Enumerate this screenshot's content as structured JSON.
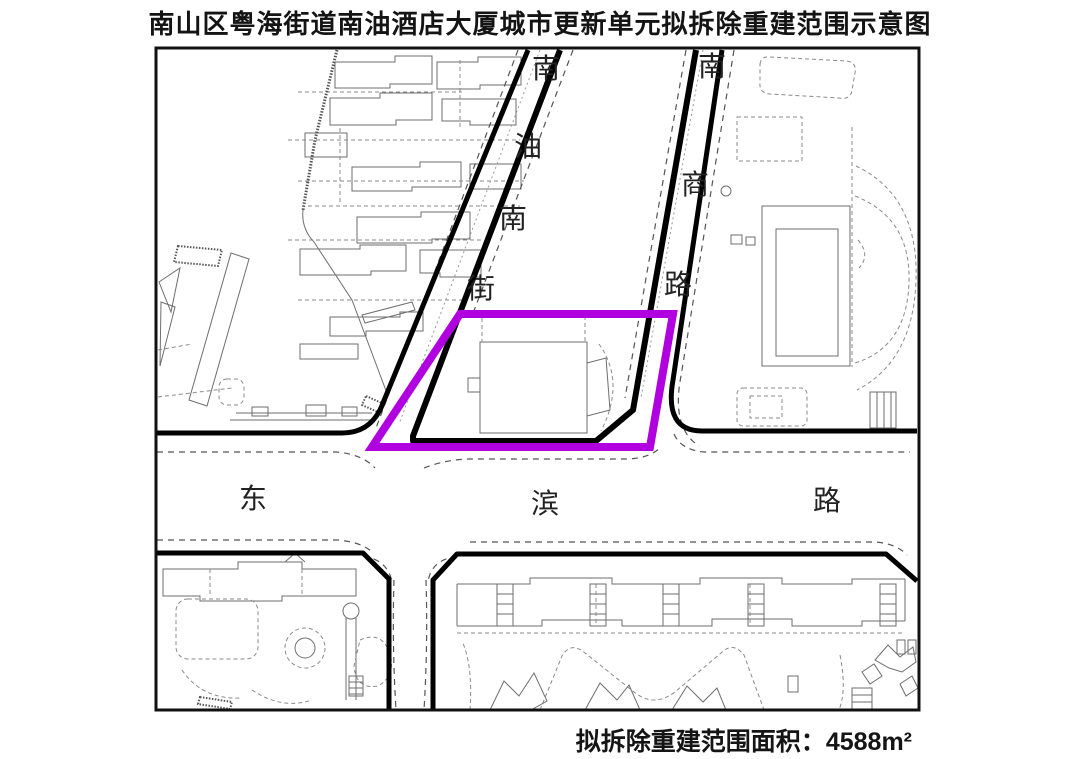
{
  "title": "南山区粤海街道南油酒店大厦城市更新单元拟拆除重建范围示意图",
  "area_note": {
    "label": "拟拆除重建范围面积：",
    "value": "4588",
    "unit": "m²"
  },
  "roads": {
    "nanyou": {
      "name": "南油南街",
      "chars": [
        "南",
        "油",
        "南",
        "街"
      ]
    },
    "nanshang": {
      "name": "南商路",
      "chars": [
        "南",
        "商",
        "路"
      ]
    },
    "dongbin": {
      "name": "东滨路",
      "chars": [
        "东",
        "滨",
        "路"
      ]
    }
  },
  "colors": {
    "boundary": "#B000E0",
    "road": "#000000",
    "frame": "#111111",
    "building": "#6E6E6E"
  }
}
